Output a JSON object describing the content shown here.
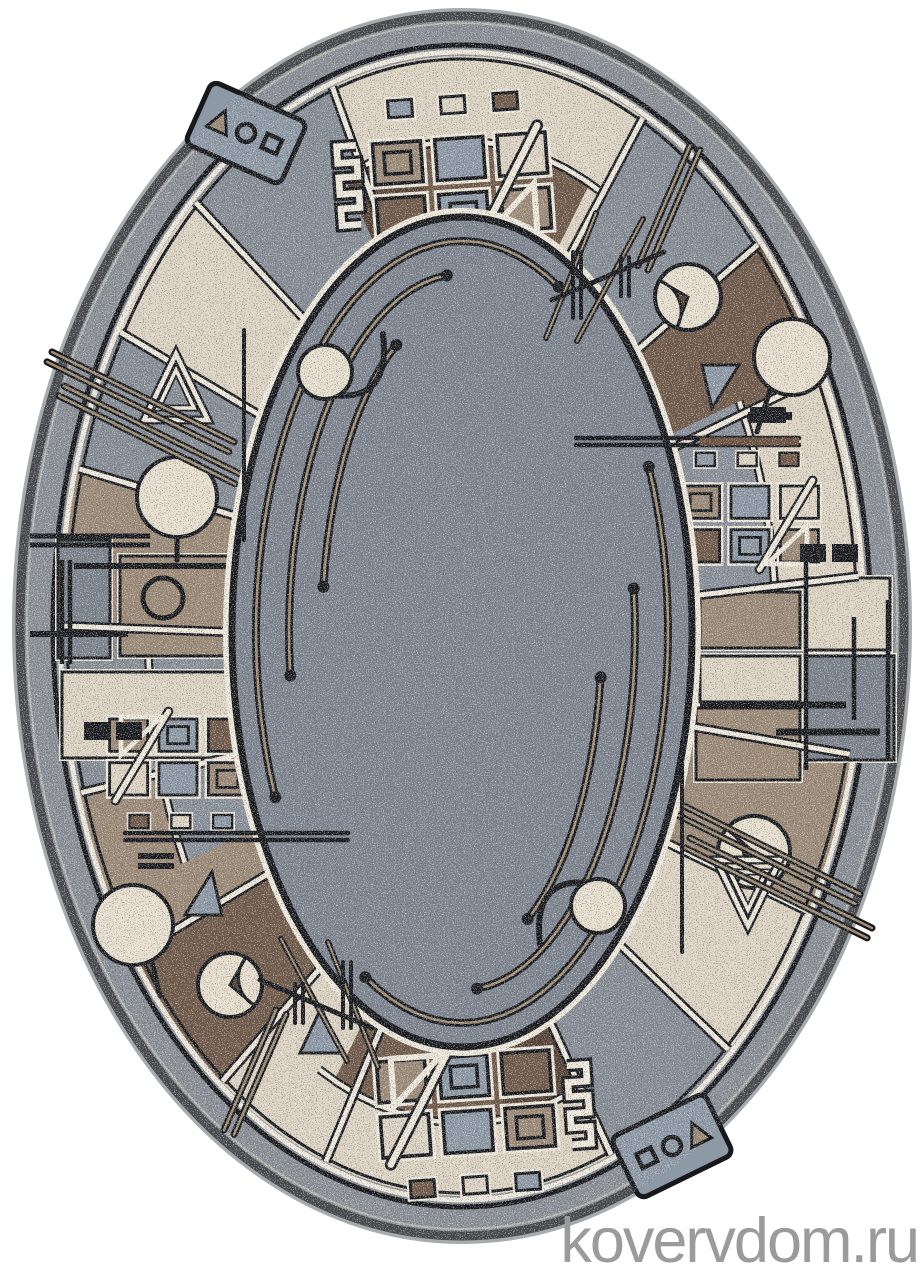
{
  "image": {
    "kind": "product-photo",
    "subject": "oval woven rug, grey centre field with beige-brown geometric Bauhaus border",
    "width": 924,
    "height": 1280,
    "background": "#ffffff"
  },
  "watermark": {
    "text": "kovervdom.ru",
    "color": "#9b9b9b",
    "font_size": 63,
    "x": 918,
    "y": 1262
  },
  "palette": {
    "cream": "#DCD3C2",
    "gray": "#868D95",
    "gray2": "#7B828B",
    "taupe": "#9C8A77",
    "brown": "#6F5948",
    "darkbrown": "#554134",
    "grayblue": "#8E99A6",
    "panelgray": "#89909A",
    "field": "#7E8590",
    "margin": "#8A8F96",
    "grout": "#EFE9DC",
    "dark": "#17181C",
    "tan": "#A08F74",
    "motifCream": "#E7DFCE",
    "rim": "#46484C",
    "edge": "#A8ABAE"
  },
  "rug": {
    "cx": 462,
    "cy": 626,
    "rx": 448,
    "ry": 616,
    "ringOuter": {
      "rx": 400,
      "ry": 570
    },
    "fieldCy": 632,
    "fieldRx": 230,
    "fieldRy": 415,
    "panelOuter": {
      "rx": 312,
      "ry": 489
    },
    "wedges": [
      {
        "from": -180,
        "to": -163,
        "fill": "gray"
      },
      {
        "from": -163,
        "to": -145,
        "fill": "taupe"
      },
      {
        "from": -145,
        "to": -127,
        "fill": "brown"
      },
      {
        "from": -127,
        "to": -110,
        "fill": "cream"
      },
      {
        "from": -110,
        "to": -68,
        "fill": "cream"
      },
      {
        "from": -68,
        "to": -48,
        "fill": "gray"
      },
      {
        "from": -48,
        "to": -30,
        "fill": "cream"
      },
      {
        "from": -30,
        "to": -13,
        "fill": "taupe"
      },
      {
        "from": -13,
        "to": 5,
        "fill": "gray"
      },
      {
        "from": 5,
        "to": 26,
        "fill": "cream"
      },
      {
        "from": 26,
        "to": 42,
        "fill": "brown"
      },
      {
        "from": 42,
        "to": 63,
        "fill": "gray"
      },
      {
        "from": 63,
        "to": 109,
        "fill": "cream"
      },
      {
        "from": 109,
        "to": 132,
        "fill": "gray"
      },
      {
        "from": 132,
        "to": 149,
        "fill": "cream"
      },
      {
        "from": 149,
        "to": 164,
        "fill": "gray"
      },
      {
        "from": 164,
        "to": 180,
        "fill": "taupe"
      }
    ],
    "panels": [
      {
        "from": 66,
        "to": 112,
        "fill": "brown"
      },
      {
        "from": 98,
        "to": 112,
        "fill": "darkbrown"
      },
      {
        "from": 246,
        "to": 292,
        "fill": "brown"
      },
      {
        "from": 278,
        "to": 292,
        "fill": "darkbrown"
      },
      {
        "from": 2,
        "to": 28,
        "fill": "panelgray"
      },
      {
        "from": 182,
        "to": 208,
        "fill": "panelgray"
      }
    ],
    "midArcs": [
      [
        63,
        109
      ],
      [
        243,
        289
      ],
      [
        2,
        28
      ],
      [
        182,
        208
      ]
    ],
    "dividers": [
      -163,
      -145,
      -127,
      -110,
      -68,
      -48,
      -30,
      -13,
      5,
      26,
      42,
      63,
      109,
      132,
      149,
      164,
      180
    ],
    "mondrian": [
      [
        58,
        540,
        52,
        118,
        "gray2"
      ],
      [
        120,
        556,
        108,
        100,
        "taupe"
      ],
      [
        62,
        672,
        168,
        86,
        "cream"
      ],
      [
        700,
        592,
        100,
        56,
        "taupe"
      ],
      [
        806,
        578,
        84,
        72,
        "cream"
      ],
      [
        700,
        656,
        100,
        46,
        "cream"
      ],
      [
        806,
        656,
        88,
        104,
        "gray2"
      ],
      [
        696,
        708,
        104,
        72,
        "taupe"
      ]
    ],
    "grids": [
      {
        "cx": 462,
        "cy": 186,
        "rot": -4,
        "s": 1.2,
        "comb": true
      },
      {
        "cx": 466,
        "cy": 1104,
        "rot": 176,
        "s": 1.2,
        "comb": true
      },
      {
        "cx": 750,
        "cy": 524,
        "rot": 0,
        "s": 0.95,
        "comb": false
      },
      {
        "cx": 178,
        "cy": 757,
        "rot": 180,
        "s": 0.95,
        "comb": false
      }
    ],
    "circles": [
      {
        "cx": 792,
        "cy": 357,
        "r": 38,
        "stem": [
          770,
          390,
          757,
          432
        ]
      },
      {
        "cx": 133,
        "cy": 925,
        "r": 40,
        "stem": [
          152,
          962,
          160,
          996
        ]
      },
      {
        "cx": 177,
        "cy": 497,
        "r": 40,
        "stem": [
          177,
          538,
          177,
          560
        ]
      }
    ],
    "ringsSmall": [
      {
        "cx": 163,
        "cy": 598,
        "r": 20
      }
    ],
    "notches": [
      {
        "cx": 688,
        "cy": 297,
        "r": 33,
        "a1": 150,
        "a2": 250
      },
      {
        "cx": 230,
        "cy": 985,
        "r": 32,
        "a1": -40,
        "a2": 60
      },
      {
        "cx": 754,
        "cy": 852,
        "r": 36,
        "a1": 140,
        "a2": 240
      }
    ],
    "nestedTris": [
      {
        "cx": 176,
        "cy": 390,
        "rot": 0
      },
      {
        "cx": 748,
        "cy": 890,
        "rot": 180
      }
    ],
    "smallTris": [
      [
        [
          185,
          915
        ],
        [
          222,
          915
        ],
        [
          212,
          872
        ]
      ],
      [
        [
          739,
          365
        ],
        [
          702,
          365
        ],
        [
          712,
          408
        ]
      ],
      [
        [
          300,
          1053
        ],
        [
          342,
          1053
        ],
        [
          321,
          1008
        ]
      ]
    ],
    "glyphPanels": [
      {
        "cx": 246,
        "cy": 133,
        "rot": 24,
        "order": [
          "tri",
          "circ",
          "sq"
        ]
      },
      {
        "cx": 672,
        "cy": 1146,
        "rot": -26,
        "order": [
          "sq",
          "circ",
          "tri"
        ]
      }
    ],
    "borderSticks": [
      {
        "x1": 52,
        "y1": 352,
        "x2": 234,
        "y2": 442
      },
      {
        "x1": 64,
        "y1": 386,
        "x2": 240,
        "y2": 474
      },
      {
        "x1": 690,
        "y1": 838,
        "x2": 872,
        "y2": 928
      },
      {
        "x1": 684,
        "y1": 806,
        "x2": 860,
        "y2": 894
      },
      {
        "x1": 700,
        "y1": 150,
        "x2": 648,
        "y2": 270
      },
      {
        "x1": 224,
        "y1": 1130,
        "x2": 276,
        "y2": 1010
      }
    ],
    "fieldSticks": [
      {
        "lines": [
          [
            596,
            213,
            546,
            338
          ],
          [
            643,
            219,
            577,
            341
          ]
        ],
        "cross": [
          552,
          300,
          664,
          252
        ]
      },
      {
        "lines": [
          [
            328,
            942,
            378,
            1067
          ],
          [
            281,
            939,
            347,
            1061
          ]
        ],
        "cross": [
          260,
          980,
          372,
          1028
        ]
      }
    ],
    "hsticks": [
      {
        "x1": 576,
        "x2": 799,
        "y": 438,
        "gap": 7,
        "brownFrom": 700
      },
      {
        "x1": 125,
        "x2": 348,
        "y": 833,
        "gap": 7,
        "brownFrom": -1
      }
    ],
    "vpairs": [
      [
        573,
        252,
        318
      ],
      [
        621,
        257,
        296
      ],
      [
        343,
        962,
        1028
      ],
      [
        295,
        984,
        1023
      ]
    ],
    "vlines": [
      [
        244,
        330,
        540
      ],
      [
        682,
        742,
        952
      ]
    ],
    "bars": [
      [
        30,
        536,
        150,
        5
      ],
      [
        30,
        545,
        150,
        5
      ],
      [
        74,
        566,
        230,
        6
      ],
      [
        30,
        634,
        128,
        6
      ],
      [
        700,
        705,
        846,
        7
      ],
      [
        776,
        732,
        880,
        7
      ],
      [
        748,
        416,
        792,
        8
      ],
      [
        138,
        856,
        174,
        6
      ],
      [
        138,
        866,
        174,
        6
      ],
      [
        750,
        410,
        786,
        6
      ],
      [
        750,
        420,
        786,
        6
      ]
    ],
    "vsegs": [
      [
        62,
        560,
        664
      ],
      [
        70,
        560,
        664
      ],
      [
        806,
        560,
        770
      ],
      [
        888,
        600,
        760
      ],
      [
        854,
        617,
        720
      ]
    ],
    "darkSquares": [
      [
        84,
        722,
        26,
        18
      ],
      [
        116,
        722,
        26,
        18
      ],
      [
        800,
        544,
        26,
        18
      ],
      [
        832,
        544,
        26,
        18
      ]
    ],
    "hookCircles": [
      {
        "cx": 325,
        "cy": 372,
        "r": 27,
        "rot": 0
      },
      {
        "cx": 598,
        "cy": 906,
        "r": 27,
        "rot": 180
      }
    ],
    "fieldArcs": [
      {
        "rx": 206,
        "ry": 391,
        "a1": 62,
        "a2": 205
      },
      {
        "rx": 173,
        "ry": 358,
        "a1": 95,
        "a2": 187
      },
      {
        "rx": 140,
        "ry": 325,
        "a1": 118,
        "a2": 172
      },
      {
        "rx": 206,
        "ry": 391,
        "a1": 242,
        "a2": 385
      },
      {
        "rx": 173,
        "ry": 358,
        "a1": 275,
        "a2": 367
      },
      {
        "rx": 140,
        "ry": 325,
        "a1": 298,
        "a2": 352
      }
    ]
  }
}
